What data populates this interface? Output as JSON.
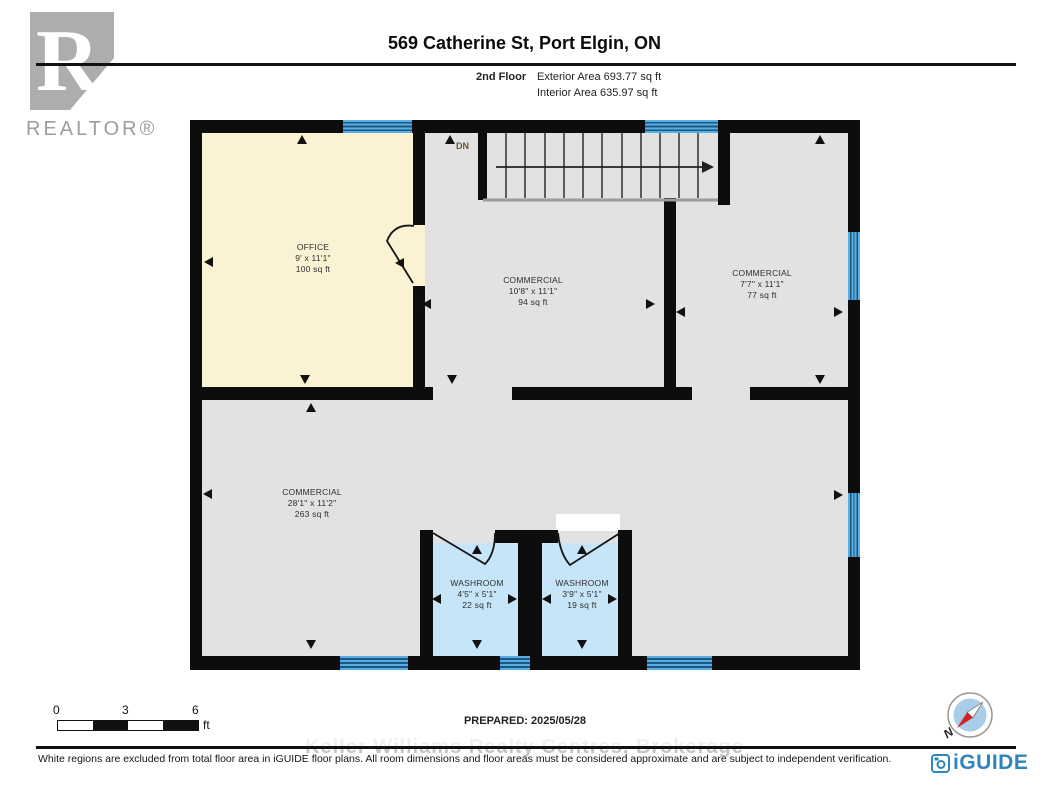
{
  "header": {
    "realtor_logo_letter": "R",
    "realtor_logo_text": "REALTOR®",
    "title": "569 Catherine St, Port Elgin, ON",
    "floor_label": "2nd Floor",
    "exterior_area": "Exterior Area 693.77 sq ft",
    "interior_area": "Interior Area 635.97 sq ft"
  },
  "floor_plan": {
    "stairs": {
      "label": "DN"
    },
    "rooms": [
      {
        "name": "OFFICE",
        "dims": "9' x 11'1\"",
        "area": "100 sq ft"
      },
      {
        "name": "COMMERCIAL",
        "dims": "10'8\" x 11'1\"",
        "area": "94 sq ft"
      },
      {
        "name": "COMMERCIAL",
        "dims": "7'7\" x 11'1\"",
        "area": "77 sq ft"
      },
      {
        "name": "COMMERCIAL",
        "dims": "28'1\" x 11'2\"",
        "area": "263 sq ft"
      },
      {
        "name": "WASHROOM",
        "dims": "4'5\" x 5'1\"",
        "area": "22 sq ft"
      },
      {
        "name": "WASHROOM",
        "dims": "3'9\" x 5'1\"",
        "area": "19 sq ft"
      }
    ],
    "colors": {
      "wall": "#0d0d0d",
      "room_fill": "#e2e2e2",
      "office_fill": "#fbf1d3",
      "washroom_fill": "#c6e5f9",
      "window": "#58ade2",
      "window_line": "#1c5880"
    }
  },
  "scale_bar": {
    "tick_0": "0",
    "tick_3": "3",
    "tick_6": "6",
    "unit": "ft"
  },
  "footer": {
    "prepared": "PREPARED: 2025/05/28",
    "watermark": "Keller Williams Realty Centres, Brokerage",
    "disclaimer": "White regions are excluded from total floor area in iGUIDE floor plans. All room dimensions and floor areas must be considered approximate and are subject to independent verification.",
    "brand": "iGUIDE",
    "compass_north_label": "N"
  }
}
